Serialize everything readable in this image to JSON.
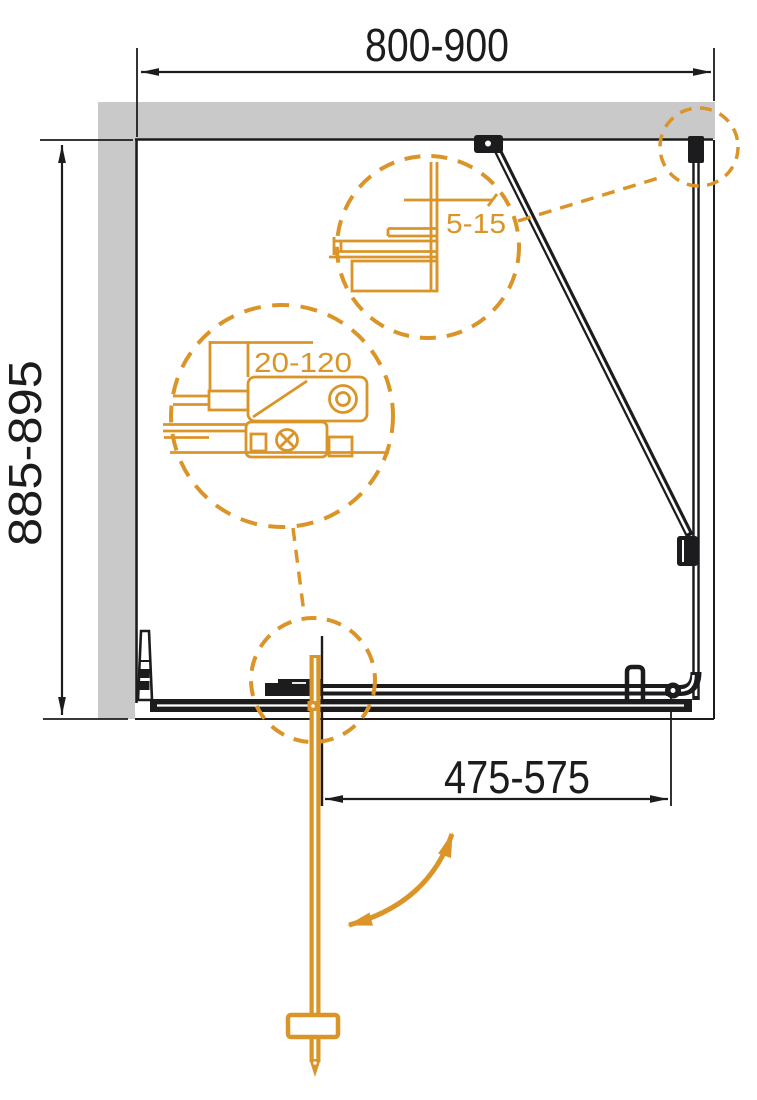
{
  "dimensions": {
    "width_range": "800-900",
    "depth_range": "885-895",
    "door_width_range": "475-575"
  },
  "detail_callouts": {
    "wall_profile_adjustment": "5-15",
    "bar_adjustment_range": "20-120"
  },
  "colors": {
    "accent_orange": "#DB9427",
    "wall_gray": "#C9C9CA",
    "line_black": "#1C1C1E",
    "background": "#FFFFFF"
  }
}
